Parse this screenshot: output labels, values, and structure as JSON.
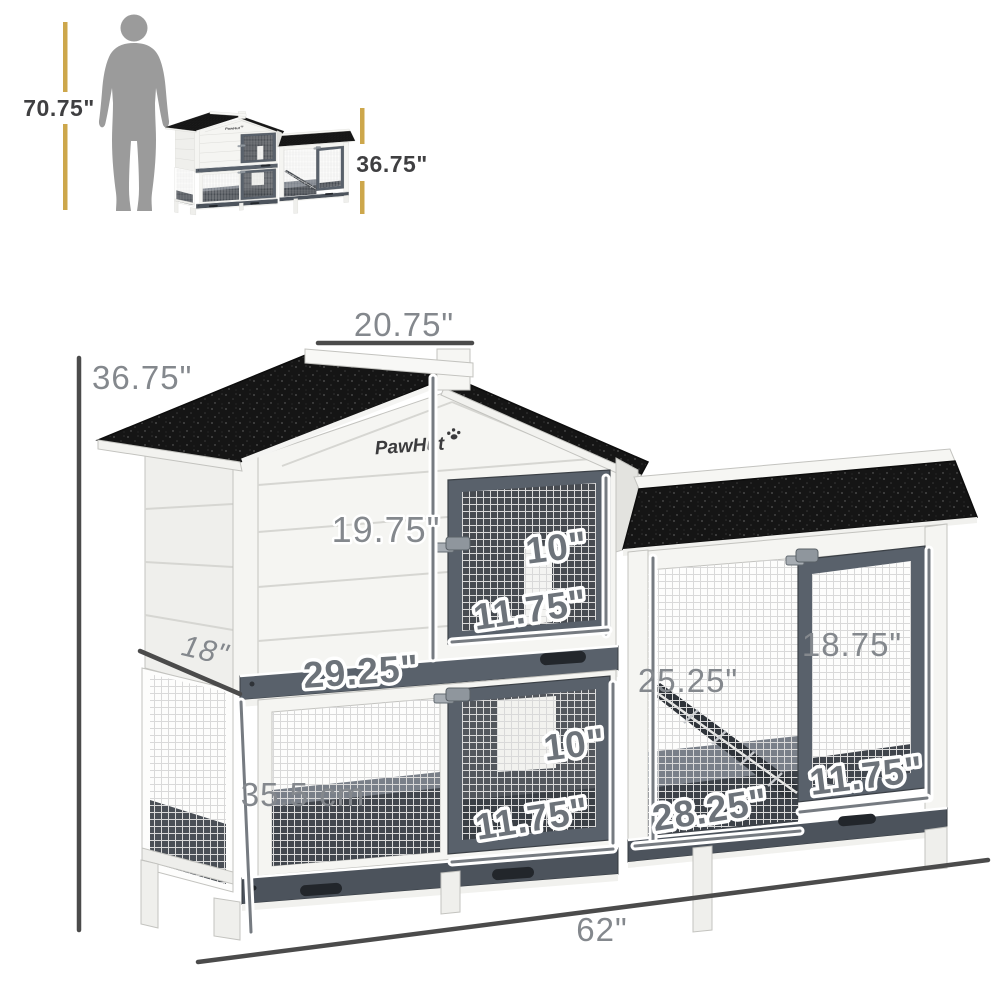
{
  "brand": {
    "logo": "PawHut"
  },
  "scale_reference": {
    "person_height": "70.75\"",
    "product_height": "36.75\""
  },
  "dimensions": {
    "roof_top_width": "20.75\"",
    "overall_height": "36.75\"",
    "hutch_face_height": "19.75\"",
    "upper_door_height": "10\"",
    "upper_door_width": "11.75\"",
    "depth": "18\"",
    "hutch_width": "29.25\"",
    "lower_cage_height": "35.5 cm",
    "lower_door_height": "10\"",
    "lower_door_width": "11.75\"",
    "run_height": "25.25\"",
    "run_door_height": "18.75\"",
    "run_door_width": "11.75\"",
    "run_width": "28.25\"",
    "overall_width": "62\""
  },
  "colors": {
    "roof": "#151515",
    "frame": "#59616b",
    "frame-dark": "#4c535c",
    "wall": "#f5f5f2",
    "dim-text": "#84888d",
    "dim-line": "#4b4b4b",
    "accent": "#cda74b",
    "silhouette": "#9b9b9b"
  }
}
